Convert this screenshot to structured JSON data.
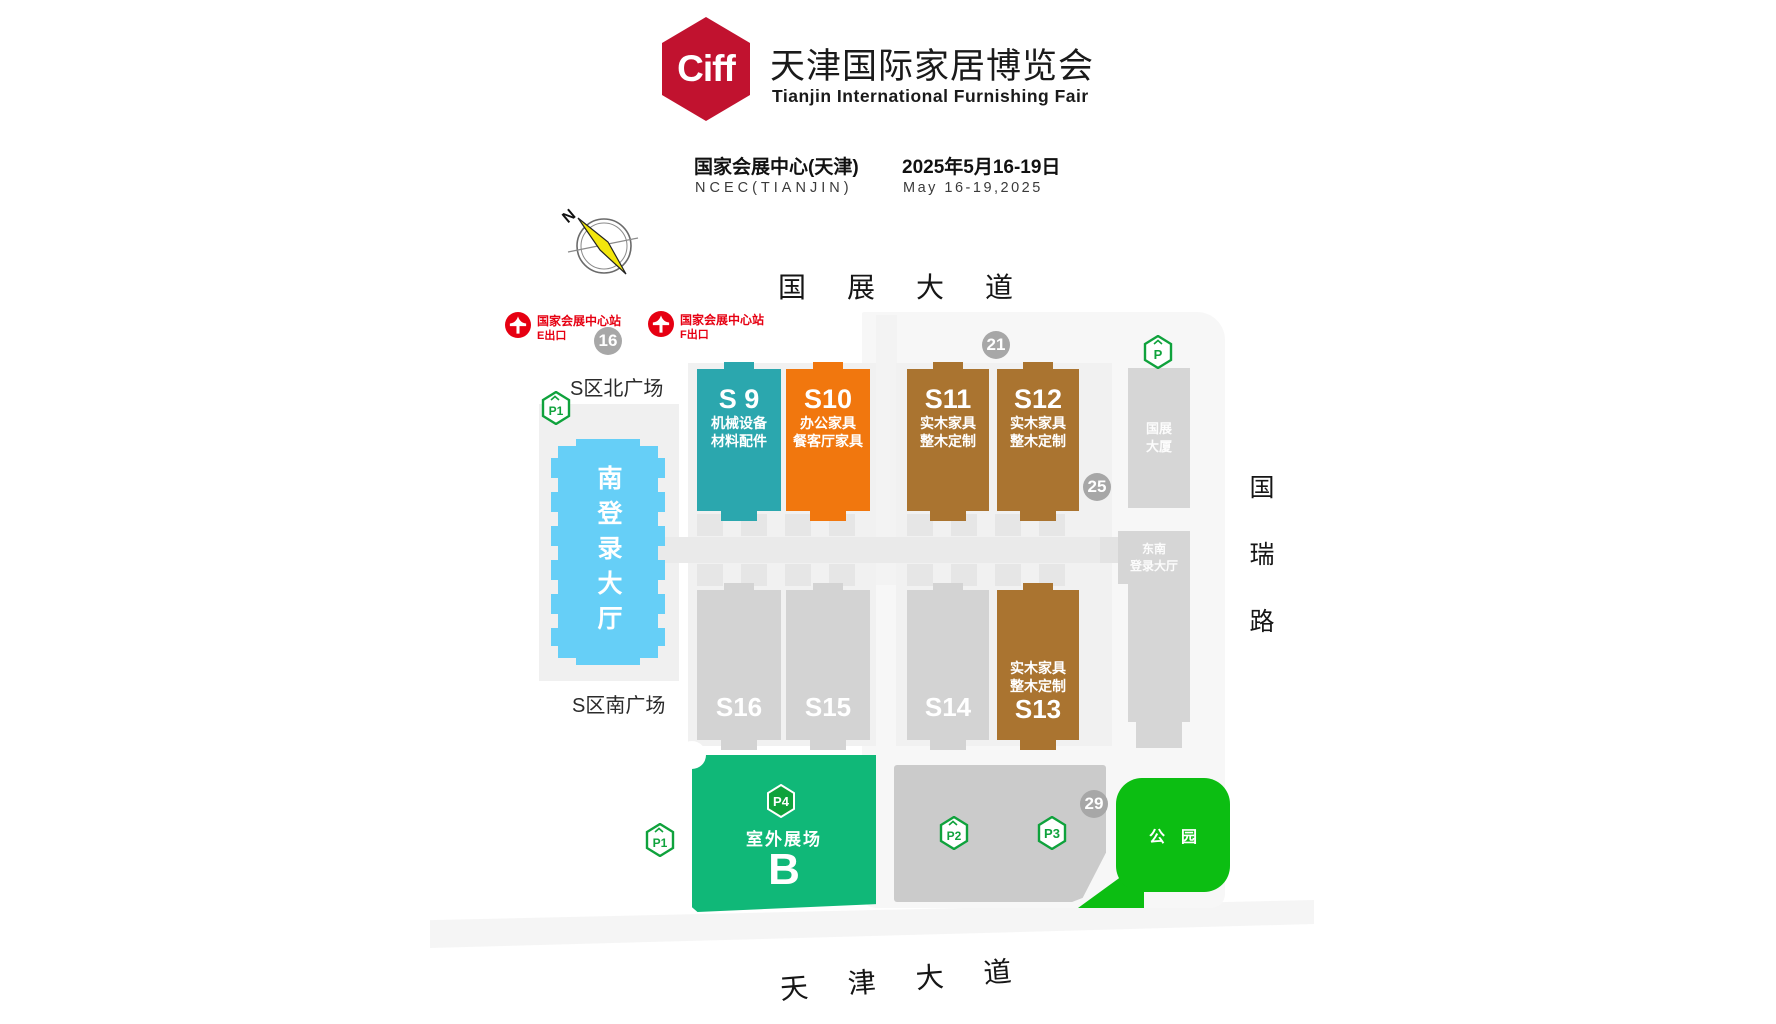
{
  "header": {
    "logo_text": "Ciff",
    "title": "天津国际家居博览会",
    "subtitle": "Tianjin International Furnishing Fair",
    "venue_cn": "国家会展中心(天津)",
    "venue_en": "NCEC(TIANJIN)",
    "date_cn": "2025年5月16-19日",
    "date_en": "May 16-19,2025"
  },
  "compass": {
    "north": "N"
  },
  "roads": {
    "top": "国展大道",
    "right": "国瑞路",
    "bottom": "天津大道"
  },
  "metro": {
    "station": "国家会展中心站",
    "exits": [
      "E出口",
      "F出口"
    ]
  },
  "plazas": {
    "north": "S区北广场",
    "south": "S区南广场"
  },
  "gates": {
    "g16": "16",
    "g21": "21",
    "g25": "25",
    "g29": "29"
  },
  "halls": {
    "south_lobby": "南登录大厅",
    "top": [
      {
        "id": "S 9",
        "line1": "机械设备",
        "line2": "材料配件",
        "color": "#2ba7ae"
      },
      {
        "id": "S10",
        "line1": "办公家具",
        "line2": "餐客厅家具",
        "color": "#f1770e"
      },
      {
        "id": "S11",
        "line1": "实木家具",
        "line2": "整木定制",
        "color": "#aa7430"
      },
      {
        "id": "S12",
        "line1": "实木家具",
        "line2": "整木定制",
        "color": "#aa7430"
      }
    ],
    "bottom": [
      {
        "id": "S16",
        "color": "#d3d3d3"
      },
      {
        "id": "S15",
        "color": "#d3d3d3"
      },
      {
        "id": "S14",
        "color": "#d3d3d3"
      },
      {
        "id": "S13",
        "line1": "实木家具",
        "line2": "整木定制",
        "color": "#aa7430"
      }
    ],
    "right": [
      {
        "line1": "国展",
        "line2": "大厦"
      },
      {
        "line1": "东南",
        "line2": "登录大厅"
      }
    ]
  },
  "outdoor": {
    "label": "室外展场",
    "zone": "B"
  },
  "park": {
    "label": "公园"
  },
  "parking": {
    "p1": "P1",
    "p2": "P2",
    "p3": "P3",
    "p4": "P4",
    "p": "P"
  },
  "colors": {
    "logo_red": "#c1122f",
    "metro_red": "#e60012",
    "teal": "#2ba7ae",
    "orange": "#f1770e",
    "brown": "#aa7430",
    "lobby_blue": "#66cff7",
    "outdoor_green": "#10b878",
    "park_green": "#0cbe12",
    "badge_green": "#0fa23c",
    "gate_gray": "#a7a7a7",
    "panel_gray": "#f7f7f7"
  }
}
